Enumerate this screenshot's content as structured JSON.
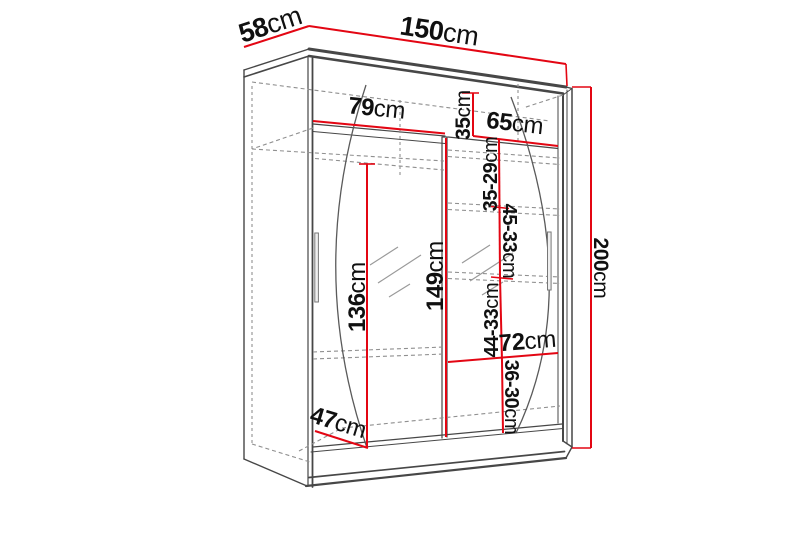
{
  "diagram": {
    "unit": "cm",
    "colors": {
      "dimension_line": "#e30613",
      "structure_line": "#474747",
      "hidden_line": "#8f8f8f",
      "label_text": "#101010",
      "background": "#ffffff"
    },
    "dimensions": {
      "top_depth": {
        "num": "58",
        "unit": "cm",
        "value": 58
      },
      "total_width": {
        "num": "150",
        "unit": "cm",
        "value": 150
      },
      "left_section_width": {
        "num": "79",
        "unit": "cm",
        "value": 79
      },
      "top_shelf_height": {
        "num": "35",
        "unit": "cm",
        "value": 35
      },
      "right_section_width": {
        "num": "65",
        "unit": "cm",
        "value": 65
      },
      "shelf_space_1": {
        "num": "35-29",
        "unit": "cm"
      },
      "shelf_space_2": {
        "num": "45-33",
        "unit": "cm"
      },
      "hanging_space_height": {
        "num": "136",
        "unit": "cm",
        "value": 136
      },
      "partition_height": {
        "num": "149",
        "unit": "cm",
        "value": 149
      },
      "shelf_space_3": {
        "num": "44-33",
        "unit": "cm"
      },
      "lower_shelf_width": {
        "num": "72",
        "unit": "cm",
        "value": 72
      },
      "shelf_space_4": {
        "num": "36-30",
        "unit": "cm"
      },
      "floor_depth": {
        "num": "47",
        "unit": "cm",
        "value": 47
      },
      "total_height": {
        "num": "200",
        "unit": "cm",
        "value": 200
      }
    }
  }
}
